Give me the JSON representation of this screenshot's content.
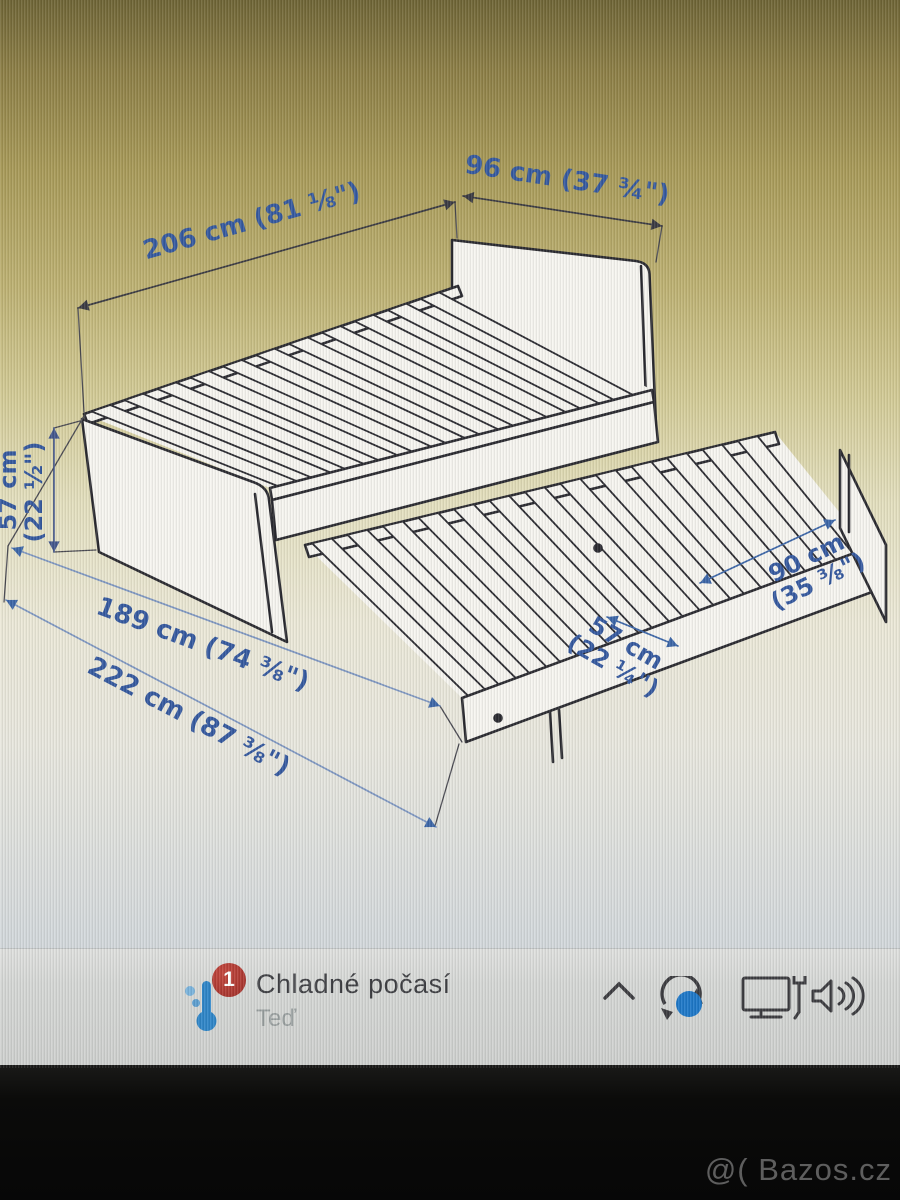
{
  "diagram": {
    "dimension_labels": {
      "total_length": "206 cm (81 ⅛\")",
      "total_width": "96 cm (37 ¾\")",
      "height_line1": "57 cm",
      "height_line2": "(22 ½\")",
      "bed_inner_length": "189 cm (74 ⅜\")",
      "extended_length": "222 cm (87 ⅜\")",
      "pullout_height_line1": "57 cm",
      "pullout_height_line2": "(22 ¼\")",
      "pullout_width_line1": "90 cm",
      "pullout_width_line2": "(35 ⅜\")"
    },
    "colors": {
      "dimension_text": "#35599f",
      "drawing_line": "#2a2a30",
      "dim_dark": "#3a3a42",
      "dim_blue": "#3c66a8",
      "dim_light": "#7e97c2",
      "height_dim": "#44578c"
    }
  },
  "taskbar": {
    "weather": {
      "badge_count": "1",
      "title": "Chladné počasí",
      "subtitle": "Teď",
      "badge_color": "#b23a33"
    },
    "tray": {
      "icons": [
        "chevron-up-icon",
        "sync-icon",
        "device-monitor-pen-icon",
        "volume-icon"
      ],
      "accent_blue": "#1e78c8"
    }
  },
  "watermark": "@( Bazos.cz"
}
